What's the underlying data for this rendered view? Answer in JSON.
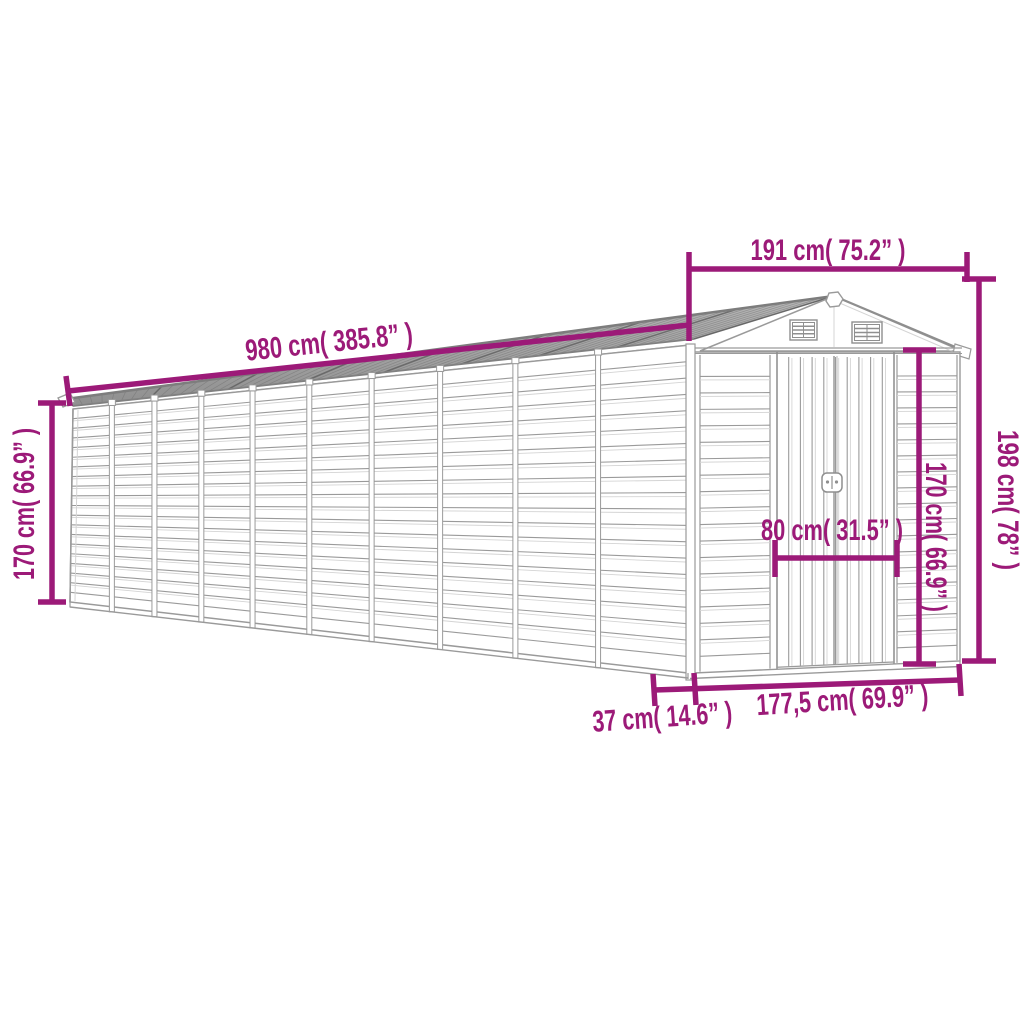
{
  "meta": {
    "description": "Line-art dimension diagram of a long metal apex-roof garden shed with gable vents and double doors",
    "background": "#ffffff",
    "accent_color": "#9c1a78",
    "line_color": "#9a9a9a",
    "line_color_dark": "#8a8a8a",
    "line_color_light": "#d4d4d4",
    "roof_fill": "#a9a9a9",
    "roof_hatch": "#6e6e6e"
  },
  "dimensions": {
    "roof_length": "980 cm( 385.8” )",
    "gable_width": "191 cm( 75.2” )",
    "side_wall_height": "170 cm( 66.9” )",
    "total_height": "198 cm( 78” )",
    "front_wall_height": "170 cm( 66.9” )",
    "door_width": "80 cm( 31.5” )",
    "base_side_depth": "37 cm( 14.6” )",
    "base_front_width": "177,5 cm( 69.9” )"
  }
}
